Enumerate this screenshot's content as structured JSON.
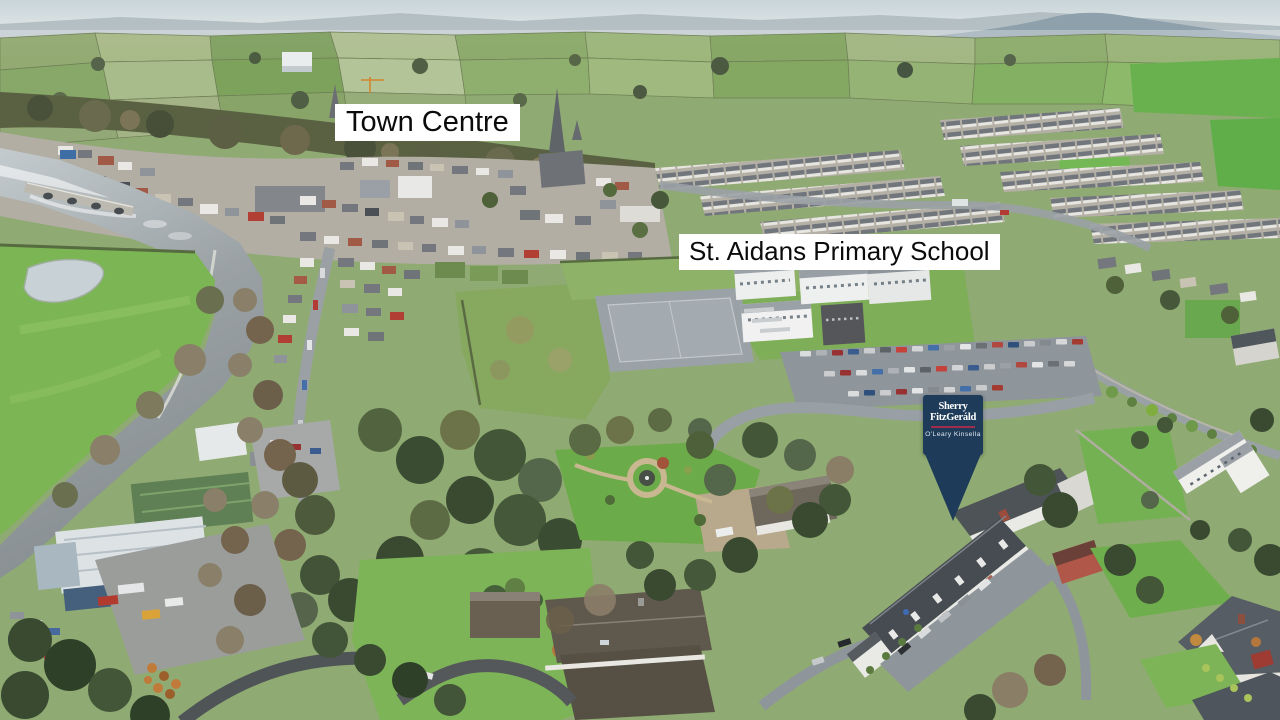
{
  "annotations": {
    "town_centre": {
      "label": "Town Centre"
    },
    "school": {
      "label": "St. Aidans Primary School"
    }
  },
  "marker": {
    "brand_top": "Sherry",
    "brand_bottom": "FitzGeráld",
    "agency": "O'Leary Kinsella",
    "colors": {
      "background": "#1e3c59",
      "divider": "#a12c4e",
      "text": "#ffffff"
    }
  },
  "annotation_style": {
    "background": "#ffffff",
    "text": "#0b0b0b"
  }
}
